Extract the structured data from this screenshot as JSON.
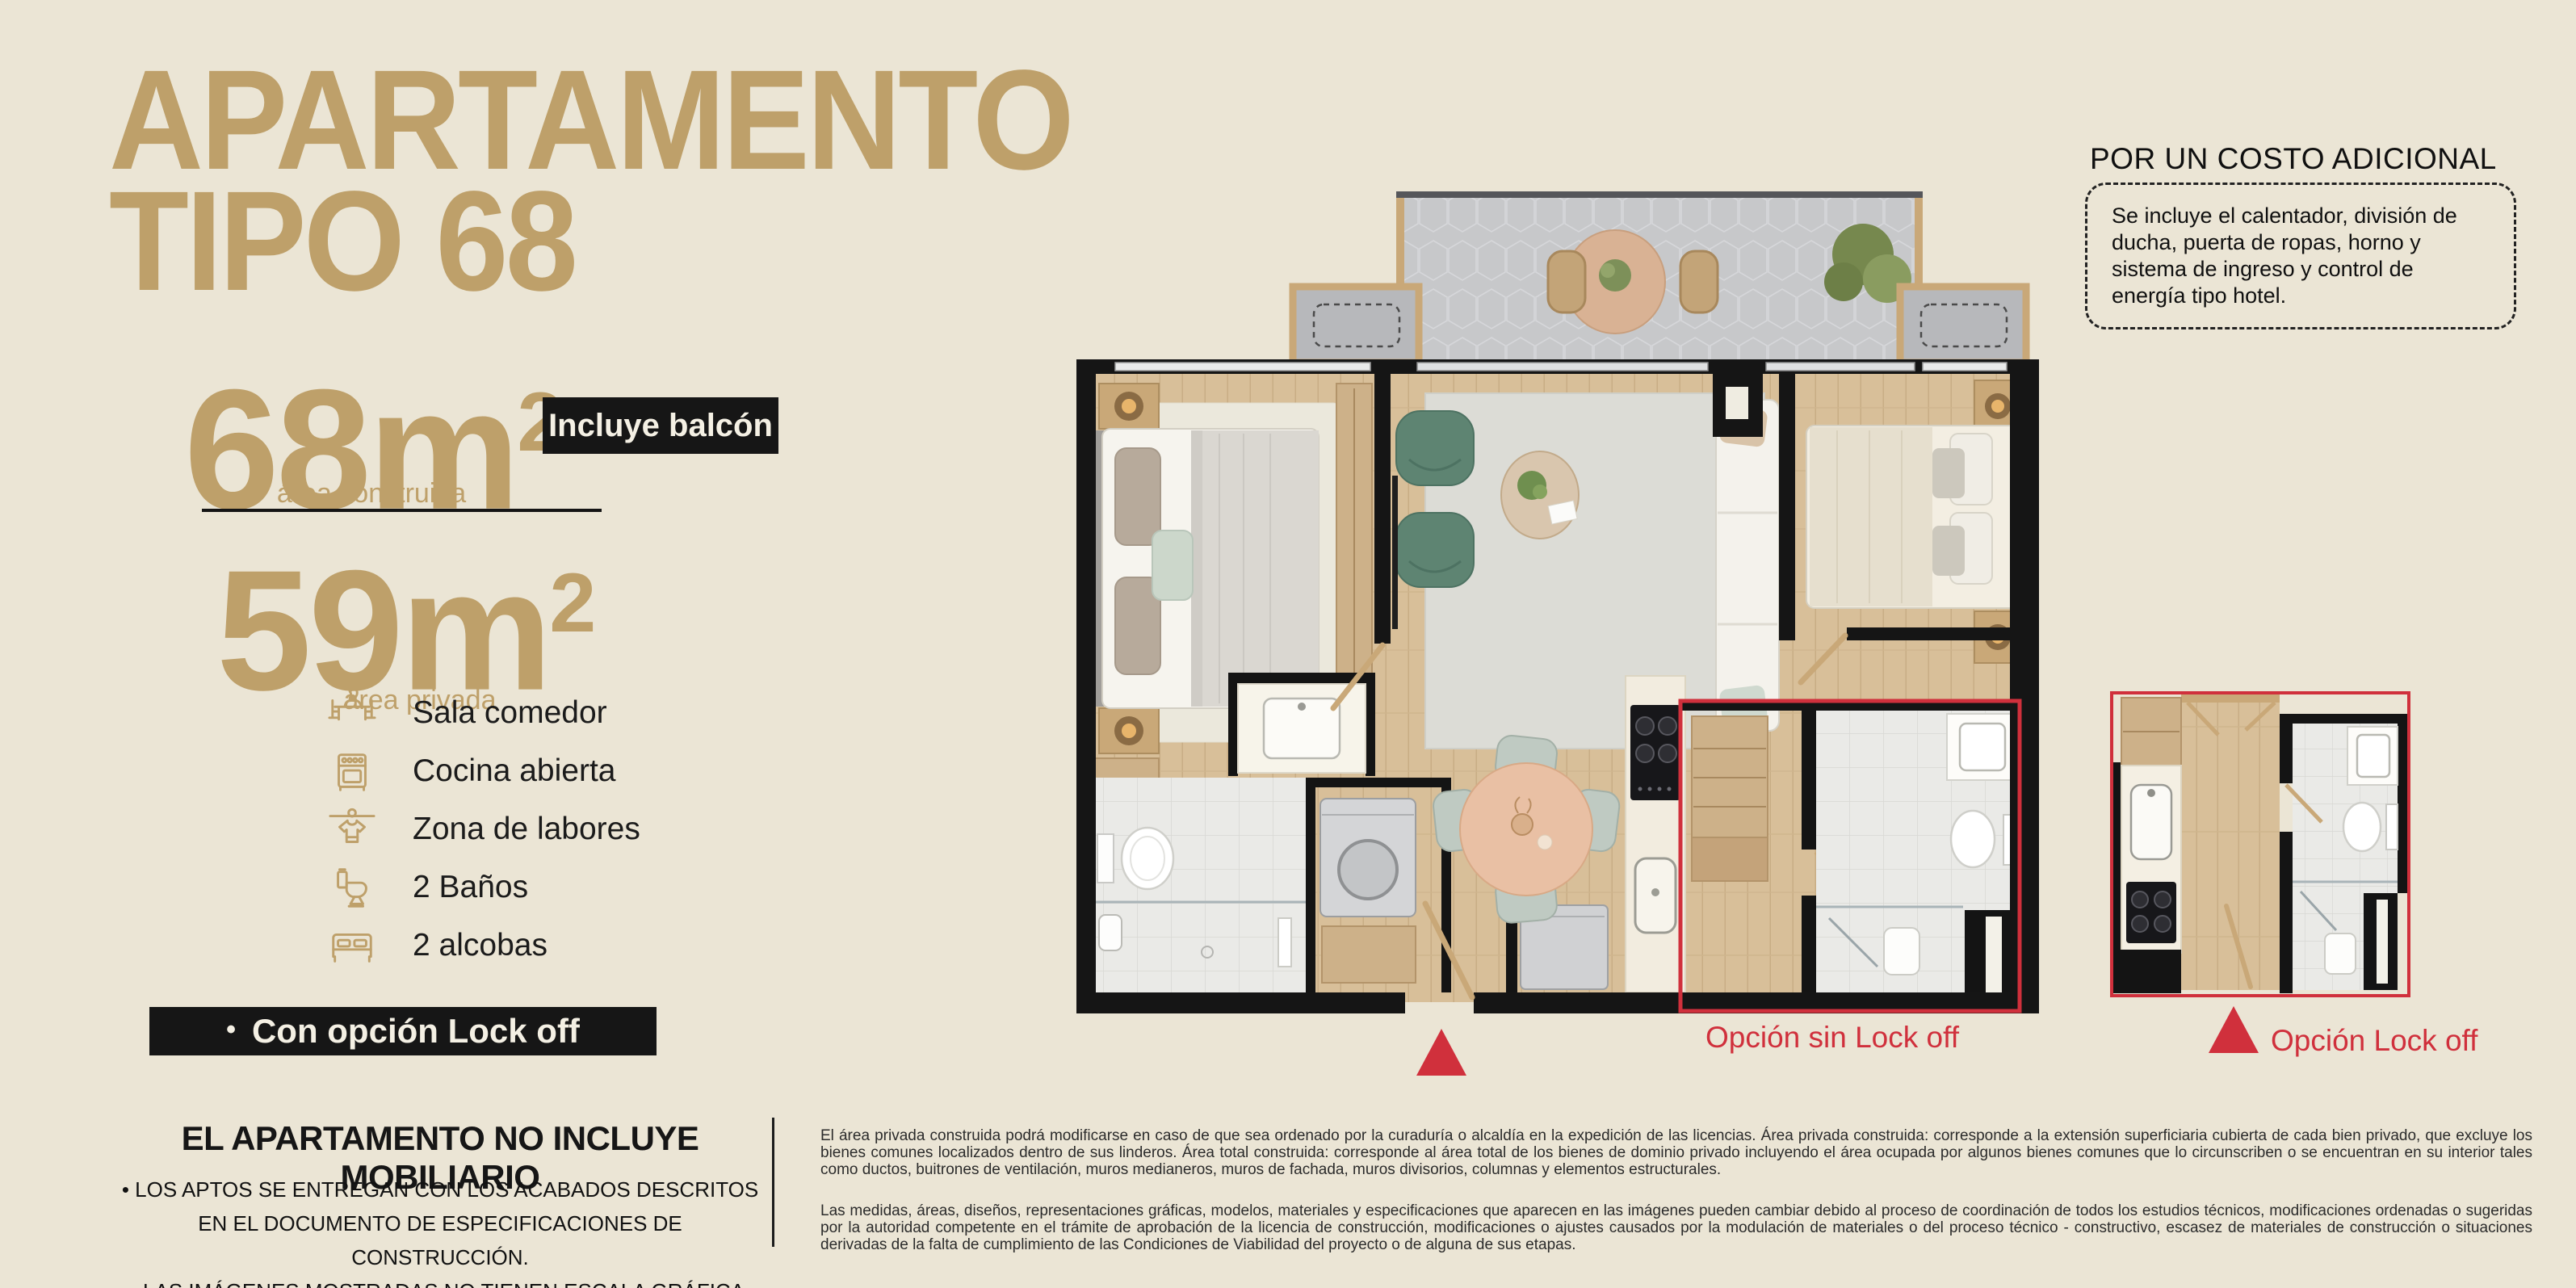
{
  "colors": {
    "background": "#EBE5D5",
    "accent_tan": "#BEA06A",
    "badge_bg": "#161616",
    "accent_red": "#D0303C"
  },
  "header": {
    "title_line1": "APARTAMENTO",
    "title_line2": "TIPO 68"
  },
  "areas": {
    "built_value": "68m",
    "built_sup": "2",
    "built_label": "área construida",
    "private_value": "59m",
    "private_sup": "2",
    "private_label": "área privada",
    "balcony_badge": "Incluye balcón"
  },
  "amenities": [
    {
      "icon": "dining-icon",
      "label": "Sala comedor"
    },
    {
      "icon": "stove-icon",
      "label": "Cocina abierta"
    },
    {
      "icon": "laundry-icon",
      "label": "Zona de labores"
    },
    {
      "icon": "toilet-icon",
      "label": "2 Baños"
    },
    {
      "icon": "bed-icon",
      "label": "2 alcobas"
    }
  ],
  "lockoff_badge": {
    "bullet": "•",
    "label": "Con opción Lock off"
  },
  "disclaimer": {
    "title": "EL APARTAMENTO NO INCLUYE MOBILIARIO",
    "bullet1": "• LOS APTOS SE ENTREGAN CON LOS ACABADOS DESCRITOS EN EL DOCUMENTO DE ESPECIFICACIONES DE CONSTRUCCIÓN.",
    "bullet2": "• LAS IMÁGENES MOSTRADAS NO TIENEN ESCALA GRÁFICA."
  },
  "additional_cost": {
    "title": "POR UN COSTO ADICIONAL",
    "body": "Se incluye el calentador, división de ducha, puerta de ropas, horno y sistema de ingreso y control de energía tipo hotel."
  },
  "plan": {
    "label_sin_lockoff": "Opción sin Lock off",
    "label_lockoff": "Opción Lock off"
  },
  "legal": {
    "paragraph1": "El área privada construida podrá modificarse en caso de que sea ordenado por la curaduría o alcaldía en la expedición de las licencias. Área privada construida: corresponde a la extensión superficiaria cubierta de cada bien privado, que excluye los bienes comunes localizados dentro de sus linderos. Área total construida: corresponde al área total de los bienes de dominio privado incluyendo el área ocupada por algunos bienes comunes que lo circunscriben o se encuentran en su interior tales como ductos, buitrones de ventilación, muros medianeros, muros de fachada, muros divisorios, columnas y elementos estructurales.",
    "paragraph2": "Las medidas, áreas, diseños, representaciones gráficas, modelos, materiales y especificaciones que aparecen en las imágenes pueden cambiar debido al proceso de coordinación de todos los estudios técnicos, modificaciones ordenadas o sugeridas por la autoridad competente en el trámite de aprobación de la licencia de construcción, modificaciones o ajustes causados por la modulación de materiales o del proceso técnico - constructivo, escasez de materiales de construcción o situaciones derivadas de la falta de cumplimiento de las Condiciones de Viabilidad del proyecto o de alguna de sus etapas."
  }
}
